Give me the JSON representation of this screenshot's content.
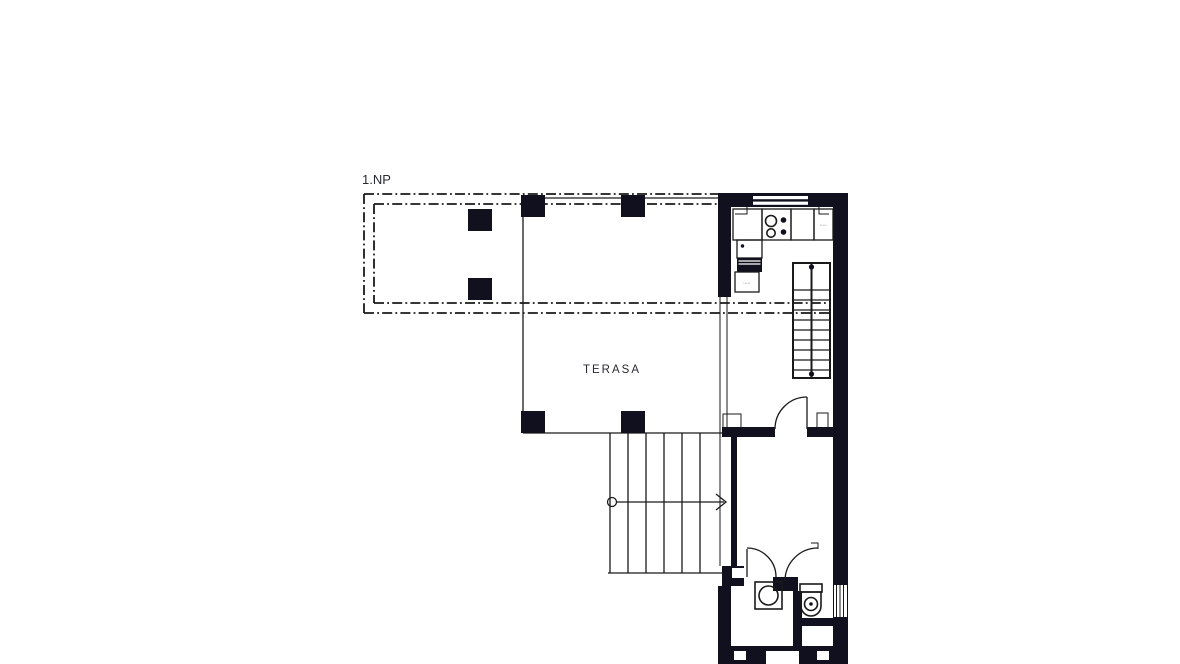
{
  "drawing": {
    "floor_label": "1.NP",
    "rooms": {
      "terrace_label": "TERASA"
    },
    "kitchen": {
      "cabinet_label_right": "•••••",
      "cabinet_label_left": "•••••"
    },
    "symbols": {
      "stove": "stove-burners-icon",
      "fridge": "fridge-filled-icon",
      "washbasin": "washbasin-icon",
      "toilet": "toilet-icon",
      "stair_direction": "stair-direction-arrow",
      "roof_overhang": "dash-dot-overhang-outline",
      "columns": "square-column"
    },
    "colors": {
      "ink": "#10101e",
      "line": "#1a1a1a",
      "label": "#2a2a33",
      "tiny": "#777777",
      "bg": "#ffffff"
    }
  }
}
